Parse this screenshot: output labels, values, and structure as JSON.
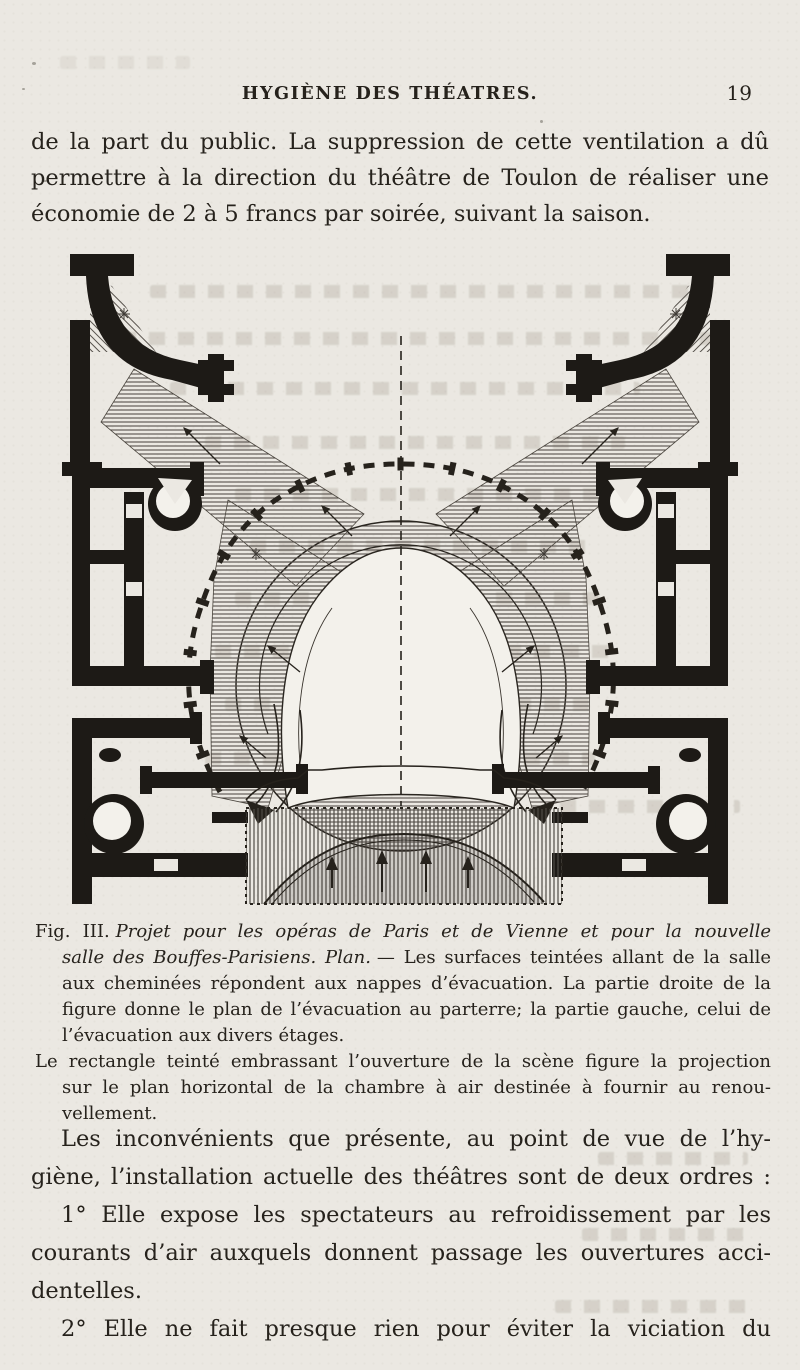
{
  "page": {
    "paper_color": "#ebe8e2",
    "ink_color": "#26221c",
    "hatch_color": "#55504a"
  },
  "header": {
    "title": "HYGIÈNE DES THÉATRES.",
    "page_number": "19"
  },
  "intro": {
    "lines": [
      "de la part du public. La suppression de cette ventilation a dû",
      "permettre à la direction du théâtre de Toulon de réaliser une",
      "économie de 2 à 5 francs par soirée, suivant la saison."
    ]
  },
  "figure": {
    "caption": {
      "fig_label": "Fig. III.",
      "title_part1": "Projet pour les opéras de Paris et de Vienne et pour la nouvelle",
      "title_part2": "salle des Bouffes-Parisiens. Plan.",
      "after_title": "— Les surfaces teintées allant de la salle",
      "line3": "aux cheminées répondent aux nappes d’évacuation. La partie droite de la",
      "line4": "figure donne le plan de l’évacuation au parterre; la partie gauche, celui de",
      "line5": "l’évacuation aux divers étages.",
      "line6": "Le rectangle teinté embrassant l’ouverture de la scène figure la projection",
      "line7": "sur le plan horizontal de la chambre à air destinée à fournir au renou-",
      "line8": "vellement."
    }
  },
  "body": {
    "p1_lines": [
      "Les inconvénients que présente, au point de vue de l’hy-",
      "giène, l’installation actuelle des théâtres sont de deux ordres :"
    ],
    "p2_lines": [
      "1° Elle expose les spectateurs au refroidissement par les",
      "courants d’air auxquels donnent passage les ouvertures acci-",
      "dentelles."
    ],
    "p3_lines": [
      "2° Elle ne fait presque rien pour éviter la viciation du"
    ]
  }
}
